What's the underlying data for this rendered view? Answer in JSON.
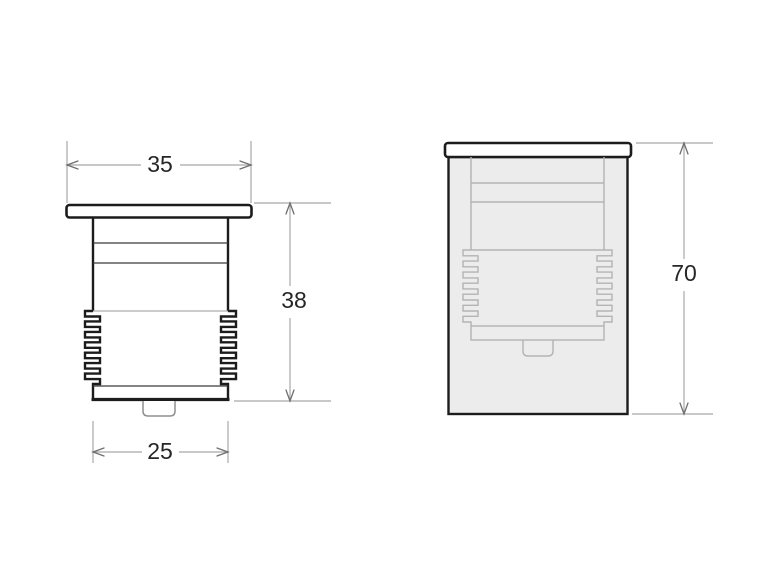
{
  "views": {
    "front": {
      "flange_width": "35",
      "height": "38",
      "body_width": "25"
    },
    "installed": {
      "overall_height": "70"
    }
  },
  "colors": {
    "background": "#ffffff",
    "outline": "#1c1c1c",
    "thin_line": "#3a3a3a",
    "gray_line": "#9a9a9a",
    "inner_line": "#b3b3b3",
    "tab_line": "#8f8f8f",
    "sleeve_fill": "#ececec",
    "dim_line": "#a8a8a8",
    "dim_arrow": "#6f6f6f",
    "dim_text": "#262626"
  }
}
